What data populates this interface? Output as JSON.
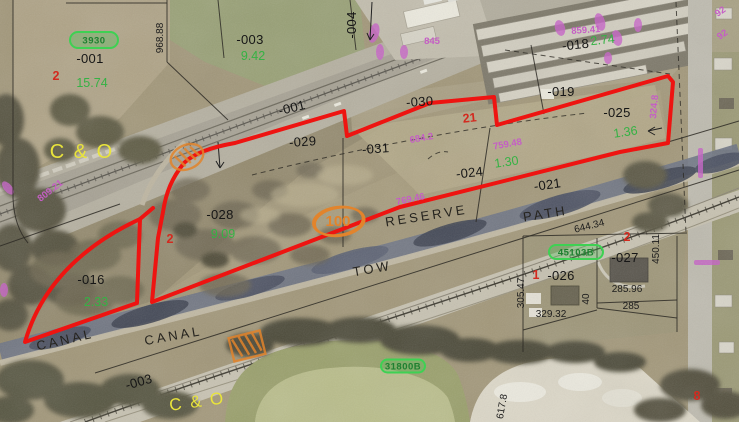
{
  "map": {
    "type": "aerial-parcel-map",
    "selected_parcel_count": 2
  },
  "colors": {
    "selected_outline": "#ee1411",
    "acreage_green": "#35b244",
    "lot_number_red": "#d32a1f",
    "dimension_magenta": "#c55ec5",
    "railroad_yellow": "#e9e43b",
    "badge_orange": "#e2842c",
    "badge_green": "#3ed153"
  },
  "labels": {
    "parcel_ids": [
      {
        "t": "-001",
        "x": 90,
        "y": 63
      },
      {
        "t": "-003",
        "x": 250,
        "y": 44
      },
      {
        "t": "-004",
        "x": 356,
        "y": 25,
        "r": -90
      },
      {
        "t": "-001",
        "x": 293,
        "y": 112,
        "r": -14
      },
      {
        "t": "-030",
        "x": 420,
        "y": 106,
        "r": -4
      },
      {
        "t": "-029",
        "x": 303,
        "y": 146,
        "r": -4
      },
      {
        "t": "-031",
        "x": 376,
        "y": 153,
        "r": -4
      },
      {
        "t": "-028",
        "x": 220,
        "y": 219
      },
      {
        "t": "-024",
        "x": 470,
        "y": 177,
        "r": -6
      },
      {
        "t": "-021",
        "x": 548,
        "y": 189,
        "r": -8
      },
      {
        "t": "-018",
        "x": 576,
        "y": 49,
        "r": -6
      },
      {
        "t": "-019",
        "x": 561,
        "y": 96
      },
      {
        "t": "-025",
        "x": 617,
        "y": 117
      },
      {
        "t": "-016",
        "x": 91,
        "y": 284
      },
      {
        "t": "-026",
        "x": 561,
        "y": 280
      },
      {
        "t": "-027",
        "x": 625,
        "y": 262
      },
      {
        "t": "-003",
        "x": 140,
        "y": 386,
        "r": -16
      }
    ],
    "acreages": [
      {
        "t": "15.74",
        "x": 92,
        "y": 87
      },
      {
        "t": "9.42",
        "x": 253,
        "y": 60
      },
      {
        "t": "2.74",
        "x": 603,
        "y": 44,
        "r": -6
      },
      {
        "t": "9.09",
        "x": 223,
        "y": 238
      },
      {
        "t": "1.30",
        "x": 507,
        "y": 166,
        "r": -8
      },
      {
        "t": "2.33",
        "x": 96,
        "y": 306
      },
      {
        "t": "1.36",
        "x": 626,
        "y": 136,
        "r": -8
      }
    ],
    "lot_numbers": [
      {
        "t": "2",
        "x": 56,
        "y": 80
      },
      {
        "t": "21",
        "x": 470,
        "y": 122,
        "r": -6
      },
      {
        "t": "2",
        "x": 170,
        "y": 243
      },
      {
        "t": "1",
        "x": 536,
        "y": 279
      },
      {
        "t": "2",
        "x": 627,
        "y": 241
      },
      {
        "t": "8",
        "x": 697,
        "y": 400
      }
    ],
    "dimensions_black": [
      {
        "t": "968.88",
        "x": 163,
        "y": 38,
        "r": -90
      },
      {
        "t": "644.34",
        "x": 590,
        "y": 229,
        "r": -14
      },
      {
        "t": "450.11",
        "x": 659,
        "y": 249,
        "r": -90
      },
      {
        "t": "285.96",
        "x": 627,
        "y": 292
      },
      {
        "t": "285",
        "x": 631,
        "y": 309
      },
      {
        "t": "329.32",
        "x": 551,
        "y": 317
      },
      {
        "t": "40",
        "x": 589,
        "y": 299,
        "r": -90
      },
      {
        "t": "305.47",
        "x": 524,
        "y": 293,
        "r": -90
      },
      {
        "t": "617.8",
        "x": 505,
        "y": 407,
        "r": -80
      }
    ],
    "dimensions_magenta": [
      {
        "t": "859.41",
        "x": 586,
        "y": 33,
        "r": -4
      },
      {
        "t": "809.21",
        "x": 52,
        "y": 193,
        "r": -38
      },
      {
        "t": "684.2",
        "x": 422,
        "y": 141,
        "r": -10
      },
      {
        "t": "759.48",
        "x": 508,
        "y": 147,
        "r": -10
      },
      {
        "t": "769.46",
        "x": 411,
        "y": 202,
        "r": -12
      },
      {
        "t": "324.8",
        "x": 657,
        "y": 107,
        "r": -85
      },
      {
        "t": "845",
        "x": 432,
        "y": 44
      },
      {
        "t": "92",
        "x": 722,
        "y": 14,
        "r": -35
      },
      {
        "t": "92",
        "x": 724,
        "y": 37,
        "r": -35
      }
    ],
    "waterway_names": [
      {
        "t": "CANAL",
        "x": 66,
        "y": 344,
        "r": -13
      },
      {
        "t": "CANAL",
        "x": 174,
        "y": 340,
        "r": -10
      },
      {
        "t": "TOW",
        "x": 373,
        "y": 273,
        "r": -10
      },
      {
        "t": "PATH",
        "x": 546,
        "y": 218,
        "r": -9
      },
      {
        "t": "RESERVE",
        "x": 427,
        "y": 220,
        "r": -9
      }
    ],
    "railroad_names": [
      {
        "t": "C & O",
        "x": 82,
        "y": 158,
        "s": 20
      },
      {
        "t": "C & O",
        "x": 198,
        "y": 407,
        "r": -8,
        "s": 17
      }
    ]
  },
  "badges": {
    "green": [
      {
        "t": "3930",
        "x": 94,
        "y": 40,
        "w": 48,
        "h": 16
      },
      {
        "t": "45103B",
        "x": 576,
        "y": 252,
        "w": 54,
        "h": 14
      },
      {
        "t": "31800B",
        "x": 403,
        "y": 366,
        "w": 44,
        "h": 13
      }
    ],
    "orange": {
      "t": "100",
      "x": 338,
      "y": 221,
      "rx": 25,
      "ry": 14
    }
  }
}
